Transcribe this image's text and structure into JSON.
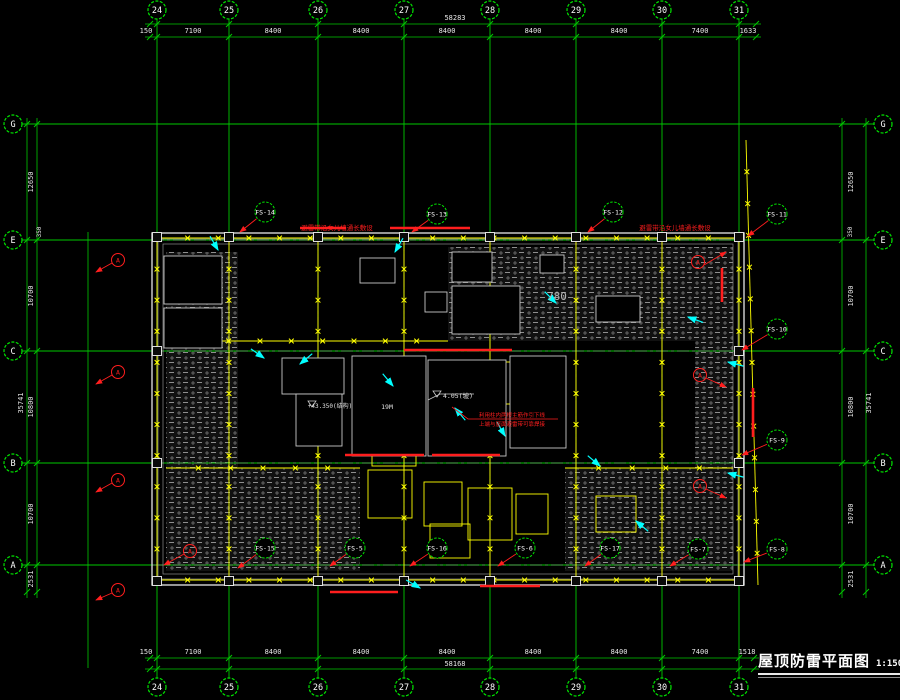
{
  "title": {
    "text": "屋顶防雷平面图",
    "scale": "1:150"
  },
  "colors": {
    "background": "#000000",
    "grid_green": "#00c800",
    "bubble_green": "#00e400",
    "belt_yellow": "#ffff00",
    "lightning_red": "#ff1e1e",
    "leader_cyan": "#00ffff",
    "outline_white": "#d6d6d6",
    "hatch_gray": "#8f8f8f",
    "dim_text": "#e6e6e6"
  },
  "grid": {
    "verticals": [
      {
        "label": "24",
        "x": 157
      },
      {
        "label": "25",
        "x": 229
      },
      {
        "label": "26",
        "x": 318
      },
      {
        "label": "27",
        "x": 404
      },
      {
        "label": "28",
        "x": 490
      },
      {
        "label": "29",
        "x": 576
      },
      {
        "label": "30",
        "x": 662
      },
      {
        "label": "31",
        "x": 739
      }
    ],
    "horizontals": [
      {
        "label": "G",
        "y": 124
      },
      {
        "label": "E",
        "y": 240
      },
      {
        "label": "C",
        "y": 351
      },
      {
        "label": "B",
        "y": 463
      },
      {
        "label": "A",
        "y": 565
      }
    ],
    "bubble_top_y": 10,
    "bubble_bottom_y": 687,
    "bubble_left_x": 13,
    "bubble_right_x": 883,
    "v_y1": 19,
    "v_y2": 678,
    "h_x1": 22,
    "h_x2": 874
  },
  "dims": {
    "top": {
      "line_total_y": 24,
      "line_seg_y": 37,
      "ticks": [
        150,
        157,
        229,
        318,
        404,
        490,
        576,
        662,
        739,
        756
      ],
      "labels": [
        {
          "v": "150",
          "x": 146
        },
        {
          "v": "7100",
          "x": 193
        },
        {
          "v": "8400",
          "x": 273
        },
        {
          "v": "8400",
          "x": 361
        },
        {
          "v": "8400",
          "x": 447
        },
        {
          "v": "8400",
          "x": 533
        },
        {
          "v": "8400",
          "x": 619
        },
        {
          "v": "7400",
          "x": 700
        },
        {
          "v": "1633",
          "x": 748
        }
      ],
      "total": {
        "v": "58283",
        "x": 455,
        "y": 20
      }
    },
    "bottom": {
      "line_total_y": 669,
      "line_seg_y": 658,
      "ticks": [
        150,
        157,
        229,
        318,
        404,
        490,
        576,
        662,
        739,
        754
      ],
      "labels": [
        {
          "v": "150",
          "x": 146
        },
        {
          "v": "7100",
          "x": 193
        },
        {
          "v": "8400",
          "x": 273
        },
        {
          "v": "8400",
          "x": 361
        },
        {
          "v": "8400",
          "x": 447
        },
        {
          "v": "8400",
          "x": 533
        },
        {
          "v": "8400",
          "x": 619
        },
        {
          "v": "7400",
          "x": 700
        },
        {
          "v": "1518",
          "x": 747
        }
      ],
      "total": {
        "v": "58168",
        "x": 455,
        "y": 666
      }
    },
    "left": {
      "line_seg_x": 37,
      "line_total_x": 27,
      "ticks": [
        124,
        240,
        351,
        463,
        565,
        592
      ],
      "labels": [
        {
          "v": "12650",
          "y": 182
        },
        {
          "v": "10700",
          "y": 296
        },
        {
          "v": "10800",
          "y": 407
        },
        {
          "v": "10700",
          "y": 514
        },
        {
          "v": "2531",
          "y": 579
        }
      ],
      "seg_text_x": 33,
      "total": {
        "v": "35741",
        "x": 23,
        "y": 403
      },
      "aux_line_x": 88
    },
    "right": {
      "line_seg_x": 842,
      "line_total_x": 866,
      "ticks": [
        124,
        240,
        351,
        463,
        565,
        592
      ],
      "labels": [
        {
          "v": "12650",
          "y": 182
        },
        {
          "v": "10700",
          "y": 296
        },
        {
          "v": "10800",
          "y": 407
        },
        {
          "v": "10700",
          "y": 514
        },
        {
          "v": "2531",
          "y": 579
        }
      ],
      "seg_text_x": 853,
      "total": {
        "v": "35741",
        "x": 871,
        "y": 403
      }
    }
  },
  "plan": {
    "outline": {
      "x1": 152,
      "y1": 233,
      "x2": 744,
      "y2": 585
    },
    "inner_lines": [
      {
        "x1": 158,
        "y1": 239,
        "x2": 738,
        "y2": 579
      },
      {
        "x1": 163,
        "y1": 244,
        "x2": 733,
        "y2": 574
      }
    ],
    "slant_belt": {
      "x1": 746,
      "y1": 140,
      "x2": 758,
      "y2": 585
    },
    "hatches": [
      [
        166,
        252,
        72,
        319
      ],
      [
        238,
        468,
        122,
        103
      ],
      [
        448,
        247,
        285,
        94
      ],
      [
        695,
        341,
        38,
        127
      ],
      [
        565,
        468,
        168,
        103
      ]
    ],
    "belt_rect": {
      "x1": 157,
      "y1": 238,
      "x2": 739,
      "y2": 580
    },
    "belt_verticals_x": [
      229,
      318,
      404,
      490,
      576,
      662
    ],
    "belt_horizontals": [
      [
        166,
        341,
        448,
        341
      ],
      [
        166,
        468,
        360,
        468
      ],
      [
        565,
        468,
        733,
        468
      ]
    ],
    "yellow_rects": [
      [
        372,
        372,
        52,
        40
      ],
      [
        430,
        380,
        46,
        56
      ],
      [
        372,
        430,
        44,
        36
      ],
      [
        484,
        362,
        40,
        42
      ],
      [
        368,
        470,
        44,
        48
      ],
      [
        424,
        482,
        38,
        44
      ],
      [
        468,
        488,
        44,
        52
      ],
      [
        516,
        494,
        32,
        40
      ],
      [
        430,
        524,
        40,
        34
      ],
      [
        596,
        496,
        40,
        36
      ]
    ],
    "white_rooms": [
      [
        352,
        356,
        74,
        100
      ],
      [
        428,
        360,
        78,
        96
      ],
      [
        282,
        358,
        62,
        36
      ],
      [
        296,
        394,
        46,
        52
      ],
      [
        510,
        356,
        56,
        92
      ],
      [
        164,
        256,
        58,
        48
      ],
      [
        164,
        308,
        58,
        40
      ],
      [
        452,
        252,
        40,
        30
      ],
      [
        452,
        286,
        68,
        48
      ],
      [
        596,
        296,
        44,
        26
      ],
      [
        360,
        258,
        35,
        25
      ],
      [
        425,
        292,
        22,
        20
      ],
      [
        540,
        255,
        24,
        18
      ]
    ],
    "columns_top_y": 237,
    "columns_bottom_y": 581,
    "columns_x": [
      157,
      229,
      318,
      404,
      490,
      576,
      662,
      739
    ],
    "columns_side_x": [
      157,
      739
    ],
    "columns_side_y": [
      351,
      463
    ],
    "red_segments": [
      [
        300,
        228,
        346,
        228
      ],
      [
        390,
        228,
        470,
        228
      ],
      [
        404,
        350,
        512,
        350
      ],
      [
        345,
        455,
        424,
        455
      ],
      [
        432,
        455,
        500,
        455
      ],
      [
        722,
        268,
        722,
        302
      ],
      [
        753,
        388,
        753,
        437
      ],
      [
        330,
        592,
        398,
        592
      ],
      [
        480,
        586,
        540,
        586
      ]
    ],
    "fs_labels": [
      {
        "t": "FS-14",
        "x": 265,
        "y": 212,
        "ex": 240,
        "ey": 232
      },
      {
        "t": "FS-13",
        "x": 437,
        "y": 214,
        "ex": 412,
        "ey": 232
      },
      {
        "t": "FS-12",
        "x": 613,
        "y": 212,
        "ex": 588,
        "ey": 232
      },
      {
        "t": "FS-11",
        "x": 777,
        "y": 214,
        "ex": 748,
        "ey": 236
      },
      {
        "t": "FS-10",
        "x": 777,
        "y": 329,
        "ex": 742,
        "ey": 350
      },
      {
        "t": "FS-9",
        "x": 777,
        "y": 440,
        "ex": 742,
        "ey": 455
      },
      {
        "t": "FS-8",
        "x": 777,
        "y": 549,
        "ex": 744,
        "ey": 562
      },
      {
        "t": "FS-7",
        "x": 698,
        "y": 549,
        "ex": 670,
        "ey": 566
      },
      {
        "t": "FS-17",
        "x": 610,
        "y": 548,
        "ex": 585,
        "ey": 566
      },
      {
        "t": "FS-6",
        "x": 525,
        "y": 548,
        "ex": 498,
        "ey": 566
      },
      {
        "t": "FS-16",
        "x": 437,
        "y": 548,
        "ex": 410,
        "ey": 566
      },
      {
        "t": "FS-5",
        "x": 355,
        "y": 548,
        "ex": 330,
        "ey": 566
      },
      {
        "t": "FS-15",
        "x": 265,
        "y": 548,
        "ex": 238,
        "ey": 568
      }
    ],
    "ground_markers": [
      {
        "t": "A",
        "x": 190,
        "y": 551,
        "dx": -26,
        "dy": 14
      },
      {
        "t": "A",
        "x": 698,
        "y": 262,
        "dx": 28,
        "dy": -10
      },
      {
        "t": "A",
        "x": 700,
        "y": 375,
        "dx": 26,
        "dy": 12
      },
      {
        "t": "A",
        "x": 700,
        "y": 486,
        "dx": 26,
        "dy": 12
      },
      {
        "t": "A",
        "x": 118,
        "y": 260,
        "dx": -22,
        "dy": 12
      },
      {
        "t": "A",
        "x": 118,
        "y": 372,
        "dx": -22,
        "dy": 12
      },
      {
        "t": "A",
        "x": 118,
        "y": 480,
        "dx": -22,
        "dy": 12
      },
      {
        "t": "A",
        "x": 118,
        "y": 590,
        "dx": -22,
        "dy": 10
      }
    ],
    "cyan_arrows": [
      [
        395,
        252,
        120
      ],
      [
        218,
        250,
        60
      ],
      [
        264,
        358,
        35
      ],
      [
        300,
        364,
        140
      ],
      [
        393,
        386,
        50
      ],
      [
        455,
        408,
        230
      ],
      [
        505,
        436,
        60
      ],
      [
        728,
        362,
        195
      ],
      [
        728,
        473,
        195
      ],
      [
        600,
        466,
        40
      ],
      [
        636,
        521,
        220
      ],
      [
        420,
        588,
        30
      ],
      [
        688,
        317,
        200
      ],
      [
        556,
        303,
        45
      ]
    ],
    "annotations_white": [
      {
        "t": "780",
        "x": 557,
        "y": 300,
        "s": 11,
        "c": "#b4b4b4"
      },
      {
        "t": "4.05(坡)",
        "x": 458,
        "y": 398,
        "s": 6.5
      },
      {
        "t": "19M",
        "x": 387,
        "y": 409,
        "s": 6.5
      },
      {
        "t": "+43.350(结构)",
        "x": 330,
        "y": 408,
        "s": 6
      },
      {
        "t": "350",
        "x": 41,
        "y": 232,
        "s": 6,
        "rot": -90
      },
      {
        "t": "350",
        "x": 852,
        "y": 232,
        "s": 6,
        "rot": -90
      }
    ],
    "annotations_red": [
      {
        "t": "避雷带沿女儿墙通长敷设",
        "x": 337,
        "y": 230,
        "s": 6.5
      },
      {
        "t": "避雷带沿女儿墙通长敷设",
        "x": 675,
        "y": 230,
        "s": 6.5
      },
      {
        "t": "利用柱内两根主筋作引下线",
        "x": 512,
        "y": 417,
        "s": 5.5
      },
      {
        "t": "上端与屋面避雷带可靠焊接",
        "x": 512,
        "y": 426,
        "s": 5.5
      }
    ],
    "leader_red": [
      [
        452,
        407
      ],
      [
        468,
        419
      ],
      [
        558,
        419
      ]
    ],
    "leader_white": [
      [
        428,
        400
      ],
      [
        440,
        394
      ],
      [
        474,
        394
      ]
    ],
    "level_triangles": [
      [
        437,
        391
      ],
      [
        312,
        401
      ]
    ]
  }
}
